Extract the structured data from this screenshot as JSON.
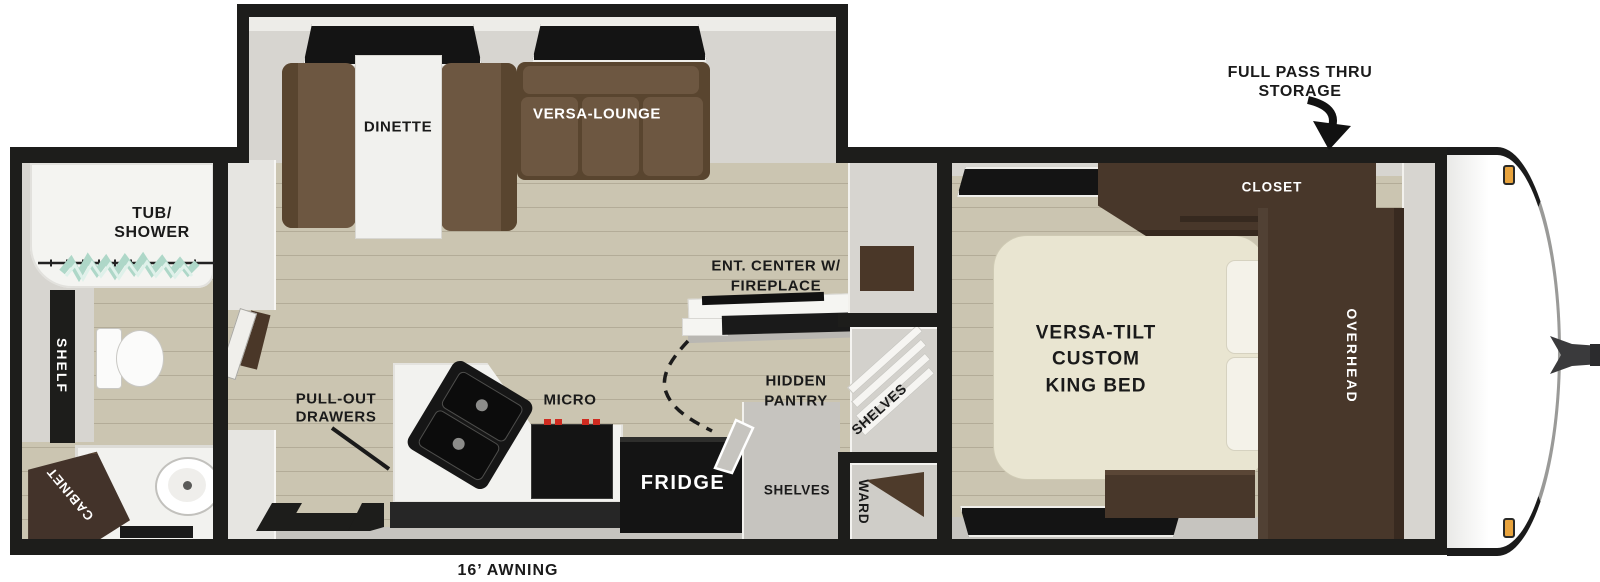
{
  "colors": {
    "wall": "#1d1d1b",
    "floor_tan": "#cbc5b1",
    "floor_gray": "#c6c4bf",
    "sofa_brown": "#6d5741",
    "cabinet_wood": "#48372a",
    "bed_cream": "#e9e5d1",
    "counter_white": "#f2f2ef",
    "appliance_black": "#141414",
    "curtain_teal": "#aed7c8",
    "marker_orange": "#e8a33d"
  },
  "annotations": {
    "pass_thru_line1": "FULL PASS THRU",
    "pass_thru_line2": "STORAGE",
    "awning": "16’ AWNING"
  },
  "bathroom": {
    "tub_line1": "TUB/",
    "tub_line2": "SHOWER",
    "shelf": "SHELF",
    "cabinet": "CABINET"
  },
  "living": {
    "dinette": "DINETTE",
    "versa_lounge": "VERSA-LOUNGE",
    "ent_center_line1": "ENT. CENTER W/",
    "ent_center_line2": "FIREPLACE",
    "pull_out_line1": "PULL-OUT",
    "pull_out_line2": "DRAWERS",
    "micro": "MICRO",
    "fridge": "FRIDGE",
    "pantry_line1": "HIDDEN",
    "pantry_line2": "PANTRY",
    "shelves_closet": "SHELVES",
    "shelves_pantry": "SHELVES",
    "ward": "WARD"
  },
  "bedroom": {
    "bed_line1": "VERSA-TILT",
    "bed_line2": "CUSTOM",
    "bed_line3": "KING BED",
    "closet": "CLOSET",
    "overhead": "OVERHEAD"
  }
}
